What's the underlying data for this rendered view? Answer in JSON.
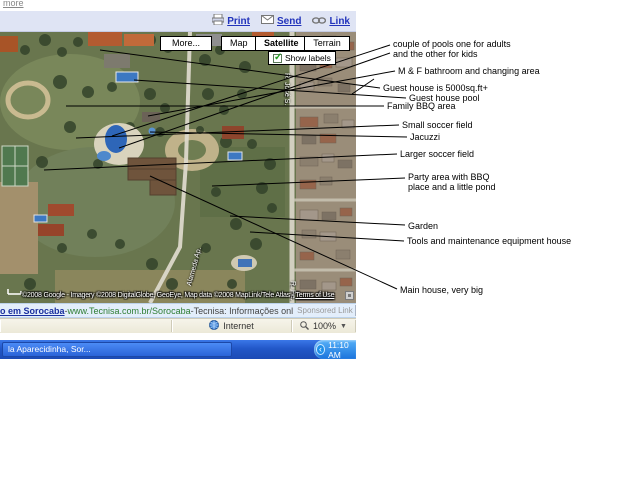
{
  "page": {
    "more_link": "more"
  },
  "toolbar": {
    "print": "Print",
    "send": "Send",
    "link": "Link"
  },
  "map": {
    "buttons": {
      "more": "More...",
      "map": "Map",
      "satellite": "Satellite",
      "terrain": "Terrain"
    },
    "show_labels": "Show labels",
    "copyright": "©2008 Google - Imagery ©2008 DigitalGlobe, GeoEye, Map data ©2008 MapLink/Tele Atlas -",
    "terms": "Terms of Use",
    "street_labels": [
      {
        "text": "R. José S.",
        "x": 290,
        "y": 73,
        "rot": 90
      },
      {
        "text": "R. Pe.",
        "x": 296,
        "y": 281,
        "rot": 90
      },
      {
        "text": "Alameda Ap.",
        "x": 186,
        "y": 285,
        "rot": -75
      }
    ]
  },
  "annotations": {
    "items": [
      {
        "lines": [
          "couple of pools one for adults",
          "and the other for kids"
        ],
        "x": 393,
        "y": 39,
        "segments": [
          [
            112,
            136,
            390,
            45
          ],
          [
            119,
            148,
            390,
            53
          ]
        ]
      },
      {
        "lines": [
          "M & F bathroom and changing area"
        ],
        "x": 398,
        "y": 66,
        "segments": [
          [
            148,
            116,
            395,
            71
          ],
          [
            352,
            94,
            374,
            79
          ]
        ]
      },
      {
        "lines": [
          "Guest house is 5000sq.ft+"
        ],
        "x": 383,
        "y": 83,
        "segments": [
          [
            100,
            50,
            380,
            88
          ]
        ]
      },
      {
        "lines": [
          "Guest house pool"
        ],
        "x": 409,
        "y": 93,
        "segments": [
          [
            134,
            80,
            406,
            98
          ]
        ]
      },
      {
        "lines": [
          "Family BBQ area"
        ],
        "x": 387,
        "y": 101,
        "segments": [
          [
            66,
            106,
            384,
            106
          ]
        ]
      },
      {
        "lines": [
          "Small soccer field"
        ],
        "x": 402,
        "y": 120,
        "segments": [
          [
            76,
            138,
            399,
            125
          ]
        ]
      },
      {
        "lines": [
          "Jacuzzi"
        ],
        "x": 410,
        "y": 132,
        "segments": [
          [
            150,
            132,
            407,
            137
          ]
        ]
      },
      {
        "lines": [
          "Larger soccer field"
        ],
        "x": 400,
        "y": 149,
        "segments": [
          [
            44,
            170,
            397,
            154
          ]
        ]
      },
      {
        "lines": [
          "Party area with BBQ",
          "place and a little pond"
        ],
        "x": 408,
        "y": 172,
        "segments": [
          [
            212,
            186,
            405,
            178
          ]
        ]
      },
      {
        "lines": [
          "Garden"
        ],
        "x": 408,
        "y": 221,
        "segments": [
          [
            230,
            216,
            405,
            225
          ]
        ]
      },
      {
        "lines": [
          "Tools and maintenance equipment house"
        ],
        "x": 407,
        "y": 236,
        "segments": [
          [
            250,
            232,
            404,
            241
          ]
        ]
      },
      {
        "lines": [
          "Main house, very big"
        ],
        "x": 400,
        "y": 285,
        "segments": [
          [
            150,
            176,
            397,
            289
          ]
        ]
      }
    ]
  },
  "sponsored": {
    "title": "o em Sorocaba",
    "sep1": " - ",
    "url": "www.Tecnisa.com.br/Sorocaba",
    "sep2": " - ",
    "desc": "Tecnisa: Informações onl",
    "tag": "Sponsored Link",
    "prev": "<",
    "next": ">"
  },
  "statusbar": {
    "zone": "Internet",
    "zoom": "100%"
  },
  "taskbar": {
    "window": "la Aparecidinha, Sor...",
    "time": "11:10 AM"
  },
  "colors": {
    "link_blue": "#2233bb",
    "taskbar_blue": "#2257c8",
    "map_green": "#69764e",
    "pool_blue": "#2e66b8"
  }
}
